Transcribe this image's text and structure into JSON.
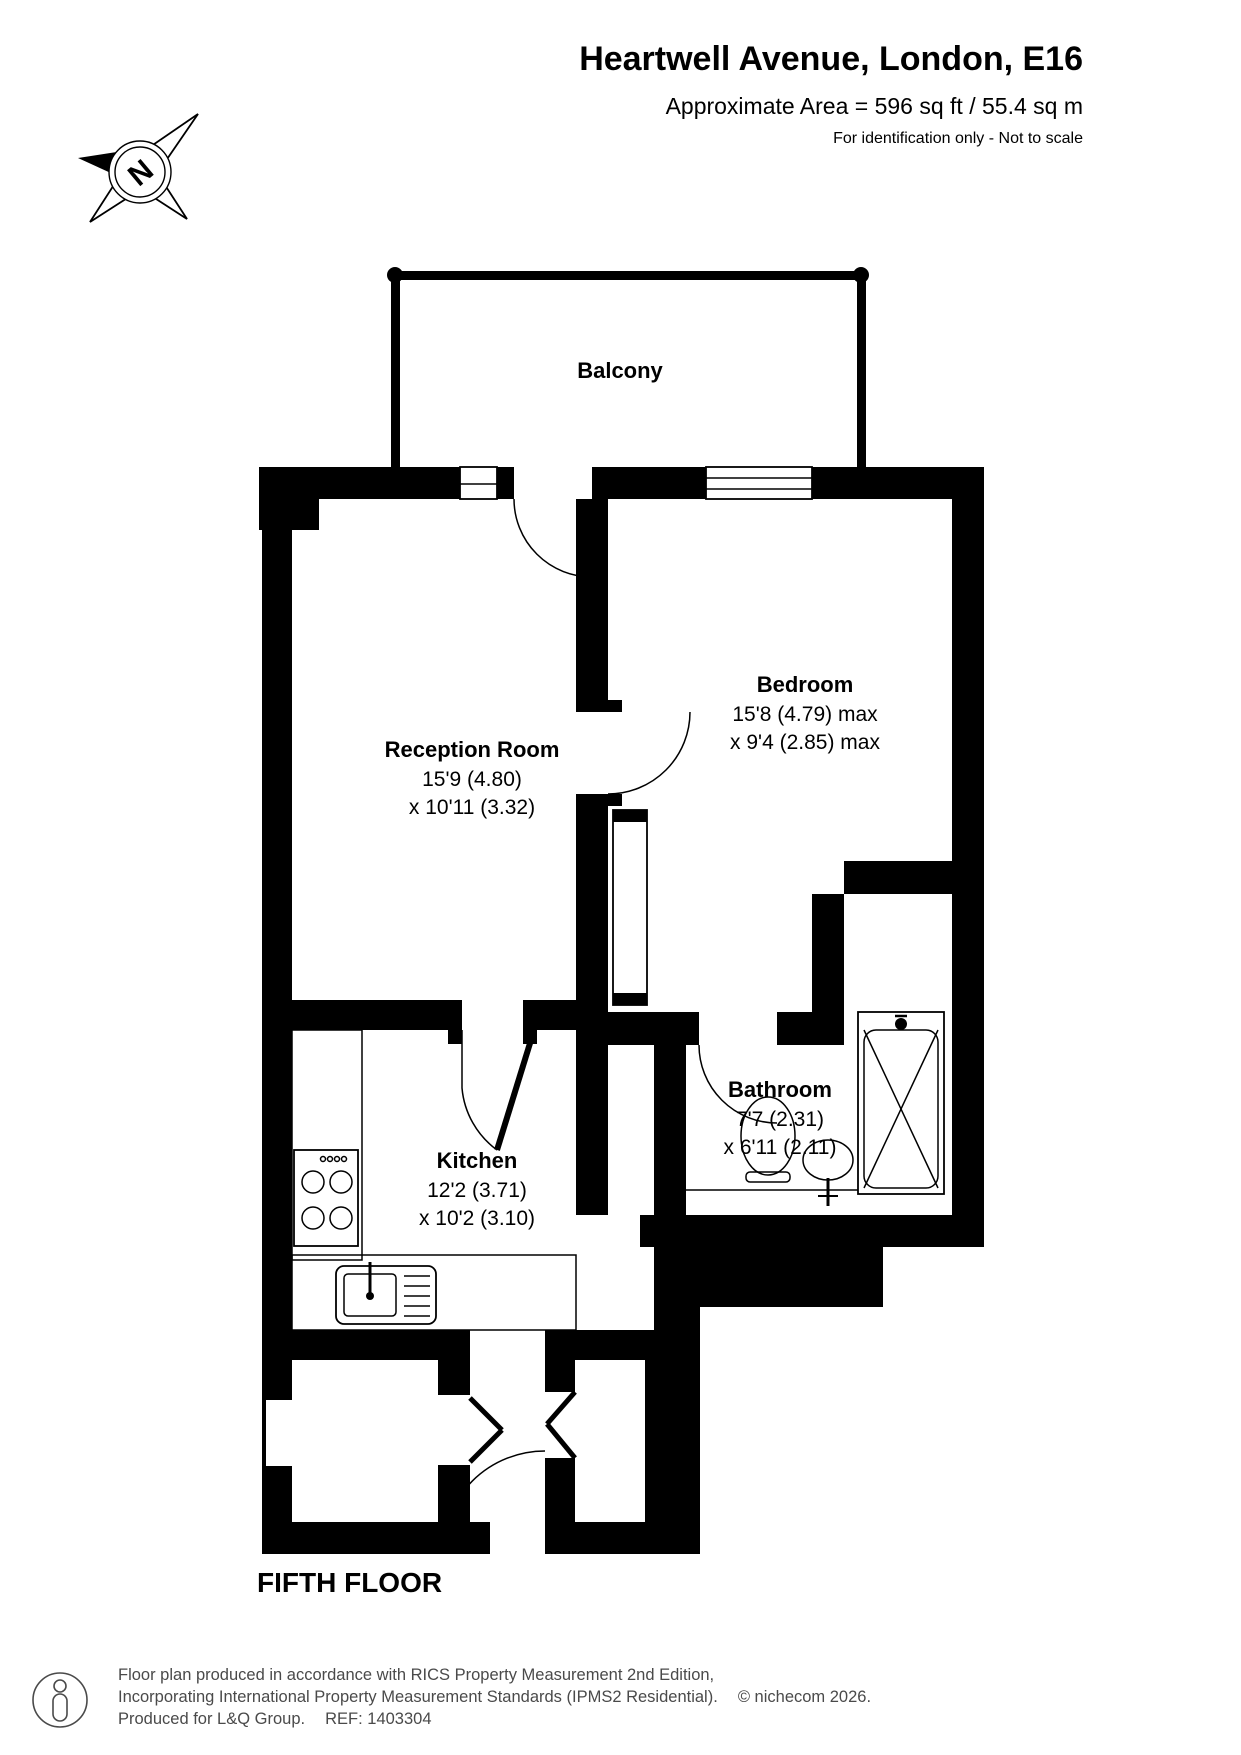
{
  "header": {
    "title": "Heartwell Avenue, London, E16",
    "area_line": "Approximate Area = 596 sq ft / 55.4 sq m",
    "disclaimer": "For identification only - Not to scale"
  },
  "compass": {
    "n_label": "N"
  },
  "floorplan": {
    "floor_label": "FIFTH FLOOR",
    "rooms": [
      {
        "name": "Balcony",
        "line1": "",
        "line2": ""
      },
      {
        "name": "Reception Room",
        "line1": "15'9 (4.80)",
        "line2": "x 10'11 (3.32)"
      },
      {
        "name": "Bedroom",
        "line1": "15'8 (4.79) max",
        "line2": "x 9'4 (2.85) max"
      },
      {
        "name": "Kitchen",
        "line1": "12'2 (3.71)",
        "line2": "x 10'2 (3.10)"
      },
      {
        "name": "Bathroom",
        "line1": "7'7 (2.31)",
        "line2": "x 6'11 (2.11)"
      }
    ]
  },
  "footer": {
    "line1": "Floor plan produced in accordance with RICS Property Measurement 2nd Edition,",
    "line2": "Incorporating International Property Measurement Standards (IPMS2 Residential).",
    "copyright": "© nichecom 2026.",
    "line3a": "Produced for L&Q Group.",
    "line3b": "REF: 1403304"
  }
}
